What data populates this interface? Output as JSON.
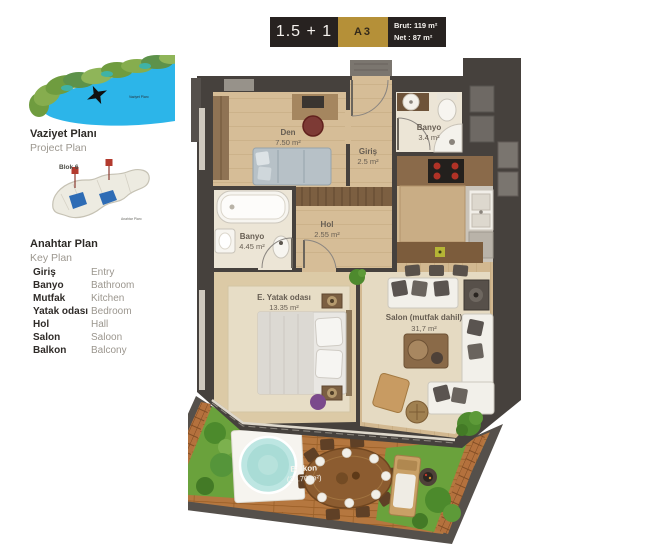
{
  "header": {
    "type_label": "1.5 + 1",
    "unit_label": "A3",
    "gross": "Brut: 119 m²",
    "net": "Net : 87 m²"
  },
  "sidebar": {
    "project_plan": {
      "title_tr": "Vaziyet Planı",
      "title_en": "Project Plan",
      "map_label": "Vaziyet Planı"
    },
    "key_plan": {
      "title_tr": "Anahtar Plan",
      "title_en": "Key Plan",
      "block_label": "Blok 6",
      "map_label": "Anahtar Planı"
    },
    "legend": [
      {
        "tr": "Giriş",
        "en": "Entry"
      },
      {
        "tr": "Banyo",
        "en": "Bathroom"
      },
      {
        "tr": "Mutfak",
        "en": "Kitchen"
      },
      {
        "tr": "Yatak odası",
        "en": "Bedroom"
      },
      {
        "tr": "Hol",
        "en": "Hall"
      },
      {
        "tr": "Salon",
        "en": "Saloon"
      },
      {
        "tr": "Balkon",
        "en": "Balcony"
      }
    ]
  },
  "floorplan": {
    "rooms": [
      {
        "name": "Den",
        "area": "7.50 m²"
      },
      {
        "name": "Giriş",
        "area": "2.5 m²"
      },
      {
        "name": "Banyo",
        "area": "3.4 m²"
      },
      {
        "name": "Banyo",
        "area": "4.45 m²"
      },
      {
        "name": "Hol",
        "area": "2.55 m²"
      },
      {
        "name": "E. Yatak odası",
        "area": "13.35 m²"
      },
      {
        "name": "Salon (mutfak dahil)",
        "area": "31,7 m²"
      },
      {
        "name": "Balkon",
        "area": "(21.70 m²)"
      }
    ]
  },
  "colors": {
    "accent_gold": "#b59038",
    "header_dark": "#272220",
    "wall": "#46413d",
    "wood_floor": "#d6bd97",
    "deck": "#b5773f",
    "grass": "#6aa23c",
    "sea": "#2cb5e9"
  }
}
